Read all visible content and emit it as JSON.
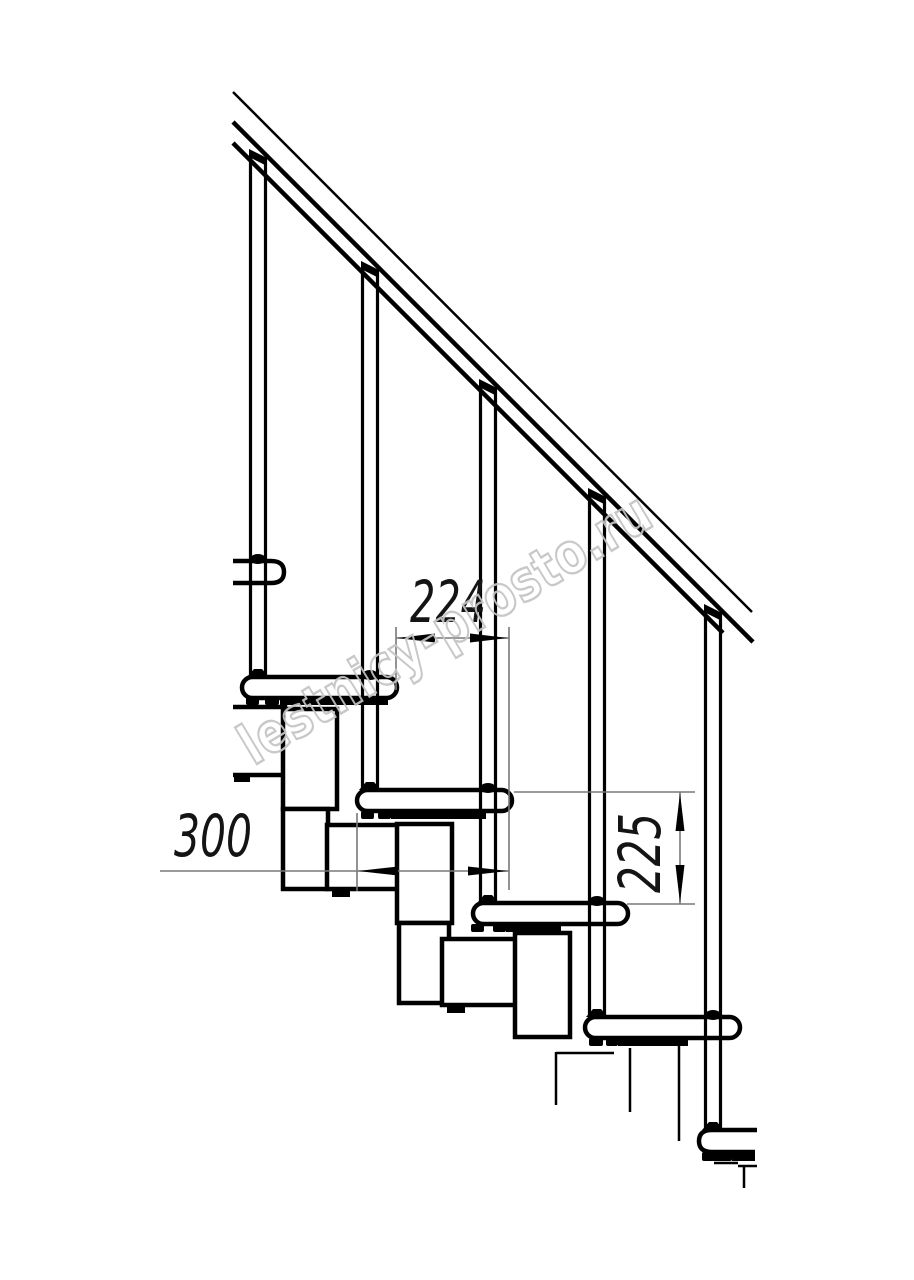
{
  "drawing": {
    "kind": "modular staircase side-view technical drawing",
    "dimensions": {
      "step_pitch_horizontal": "224",
      "step_length": "300",
      "step_rise_vertical": "225"
    },
    "watermark": {
      "text": "lestnicy-prosto.ru"
    },
    "colors": {
      "line": "#000000",
      "dimension_line": "#787878",
      "dimension_text": "#141414",
      "watermark": "#c4c4c4",
      "background": "#ffffff"
    }
  }
}
